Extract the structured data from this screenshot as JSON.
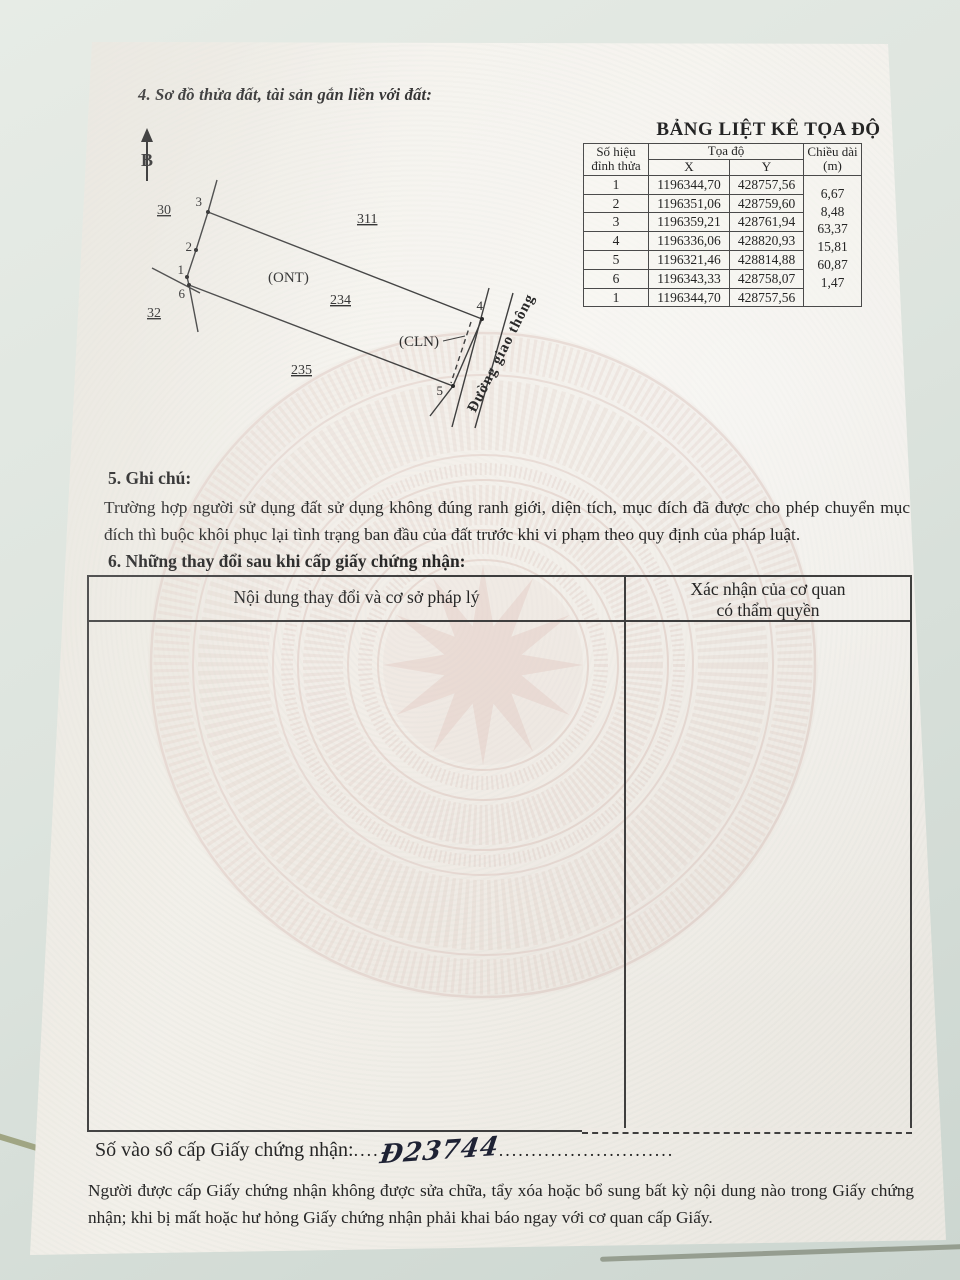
{
  "section4": {
    "heading": "4. Sơ đồ thửa đất, tài sản gắn liền với đất:"
  },
  "diagram": {
    "north_label": "B",
    "adjacent_plots": {
      "p30": "30",
      "p311": "311",
      "p32": "32",
      "p234": "234",
      "p235": "235"
    },
    "land_use_labels": {
      "ont": "(ONT)",
      "cln": "(CLN)"
    },
    "vertices": {
      "v1": "1",
      "v2": "2",
      "v3": "3",
      "v4": "4",
      "v5": "5",
      "v6": "6"
    },
    "road_label": "Đường giao thông"
  },
  "coord_table": {
    "title": "BẢNG LIỆT KÊ TỌA ĐỘ",
    "header": {
      "vertex": "Số hiệu đỉnh thửa",
      "coords": "Tọa độ",
      "x": "X",
      "y": "Y",
      "length": "Chiều dài (m)"
    },
    "rows": [
      {
        "v": "1",
        "x": "1196344,70",
        "y": "428757,56"
      },
      {
        "v": "2",
        "x": "1196351,06",
        "y": "428759,60"
      },
      {
        "v": "3",
        "x": "1196359,21",
        "y": "428761,94"
      },
      {
        "v": "4",
        "x": "1196336,06",
        "y": "428820,93"
      },
      {
        "v": "5",
        "x": "1196321,46",
        "y": "428814,88"
      },
      {
        "v": "6",
        "x": "1196343,33",
        "y": "428758,07"
      },
      {
        "v": "1",
        "x": "1196344,70",
        "y": "428757,56"
      }
    ],
    "lengths": [
      "6,67",
      "8,48",
      "63,37",
      "15,81",
      "60,87",
      "1,47"
    ]
  },
  "section5": {
    "heading": "5. Ghi chú:",
    "body": "Trường hợp người sử dụng đất sử dụng không đúng ranh giới, diện tích, mục đích đã được cho phép chuyển mục đích thì buộc khôi phục lại tình trạng ban đầu của đất trước khi vi phạm theo quy định của pháp luật."
  },
  "section6": {
    "heading": "6. Những thay đổi sau khi cấp giấy chứng nhận:",
    "table": {
      "col_content": "Nội dung thay đổi và cơ sở pháp lý",
      "col_confirm": "Xác nhận của cơ quan có thẩm quyền"
    }
  },
  "footer": {
    "serial_label": "Số vào sổ cấp Giấy chứng nhận:",
    "dots_lead": "....",
    "serial_value": "Đ23744",
    "dots_trail": "...........................",
    "note": "Người được cấp Giấy chứng nhận không được sửa chữa, tẩy xóa hoặc bổ sung bất kỳ nội dung nào trong Giấy chứng nhận; khi bị mất hoặc hư hỏng Giấy chứng nhận phải khai báo ngay với cơ quan cấp Giấy."
  }
}
